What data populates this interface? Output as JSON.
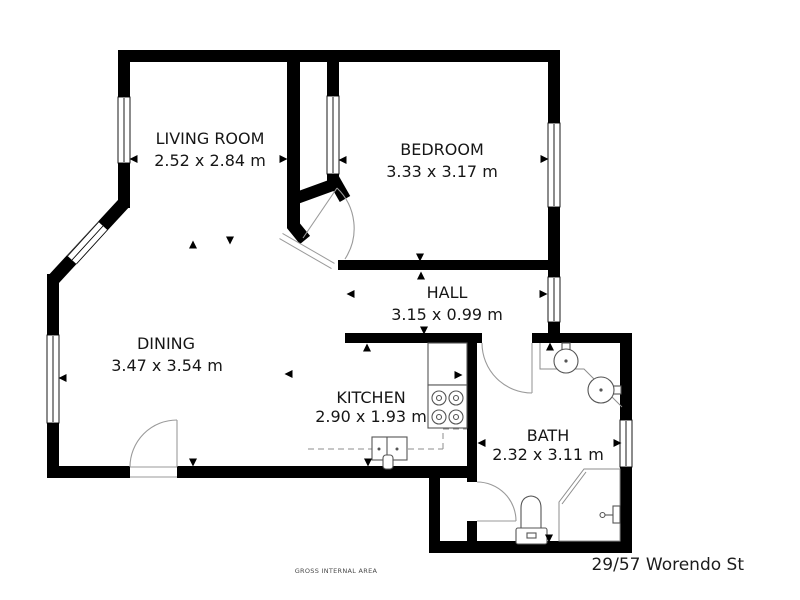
{
  "floorplan": {
    "rooms": [
      {
        "name": "LIVING ROOM",
        "dims": "2.52 x 2.84 m"
      },
      {
        "name": "BEDROOM",
        "dims": "3.33 x 3.17 m"
      },
      {
        "name": "HALL",
        "dims": "3.15 x 0.99 m"
      },
      {
        "name": "DINING",
        "dims": "3.47 x 3.54 m"
      },
      {
        "name": "KITCHEN",
        "dims": "2.90 x 1.93 m"
      },
      {
        "name": "BATH",
        "dims": "2.32 x 3.11 m"
      }
    ],
    "footer_note": "GROSS INTERNAL AREA",
    "address": "29/57 Worendo St",
    "colors": {
      "walls": "#000000",
      "background": "#ffffff",
      "fixtures": "#666666"
    }
  }
}
